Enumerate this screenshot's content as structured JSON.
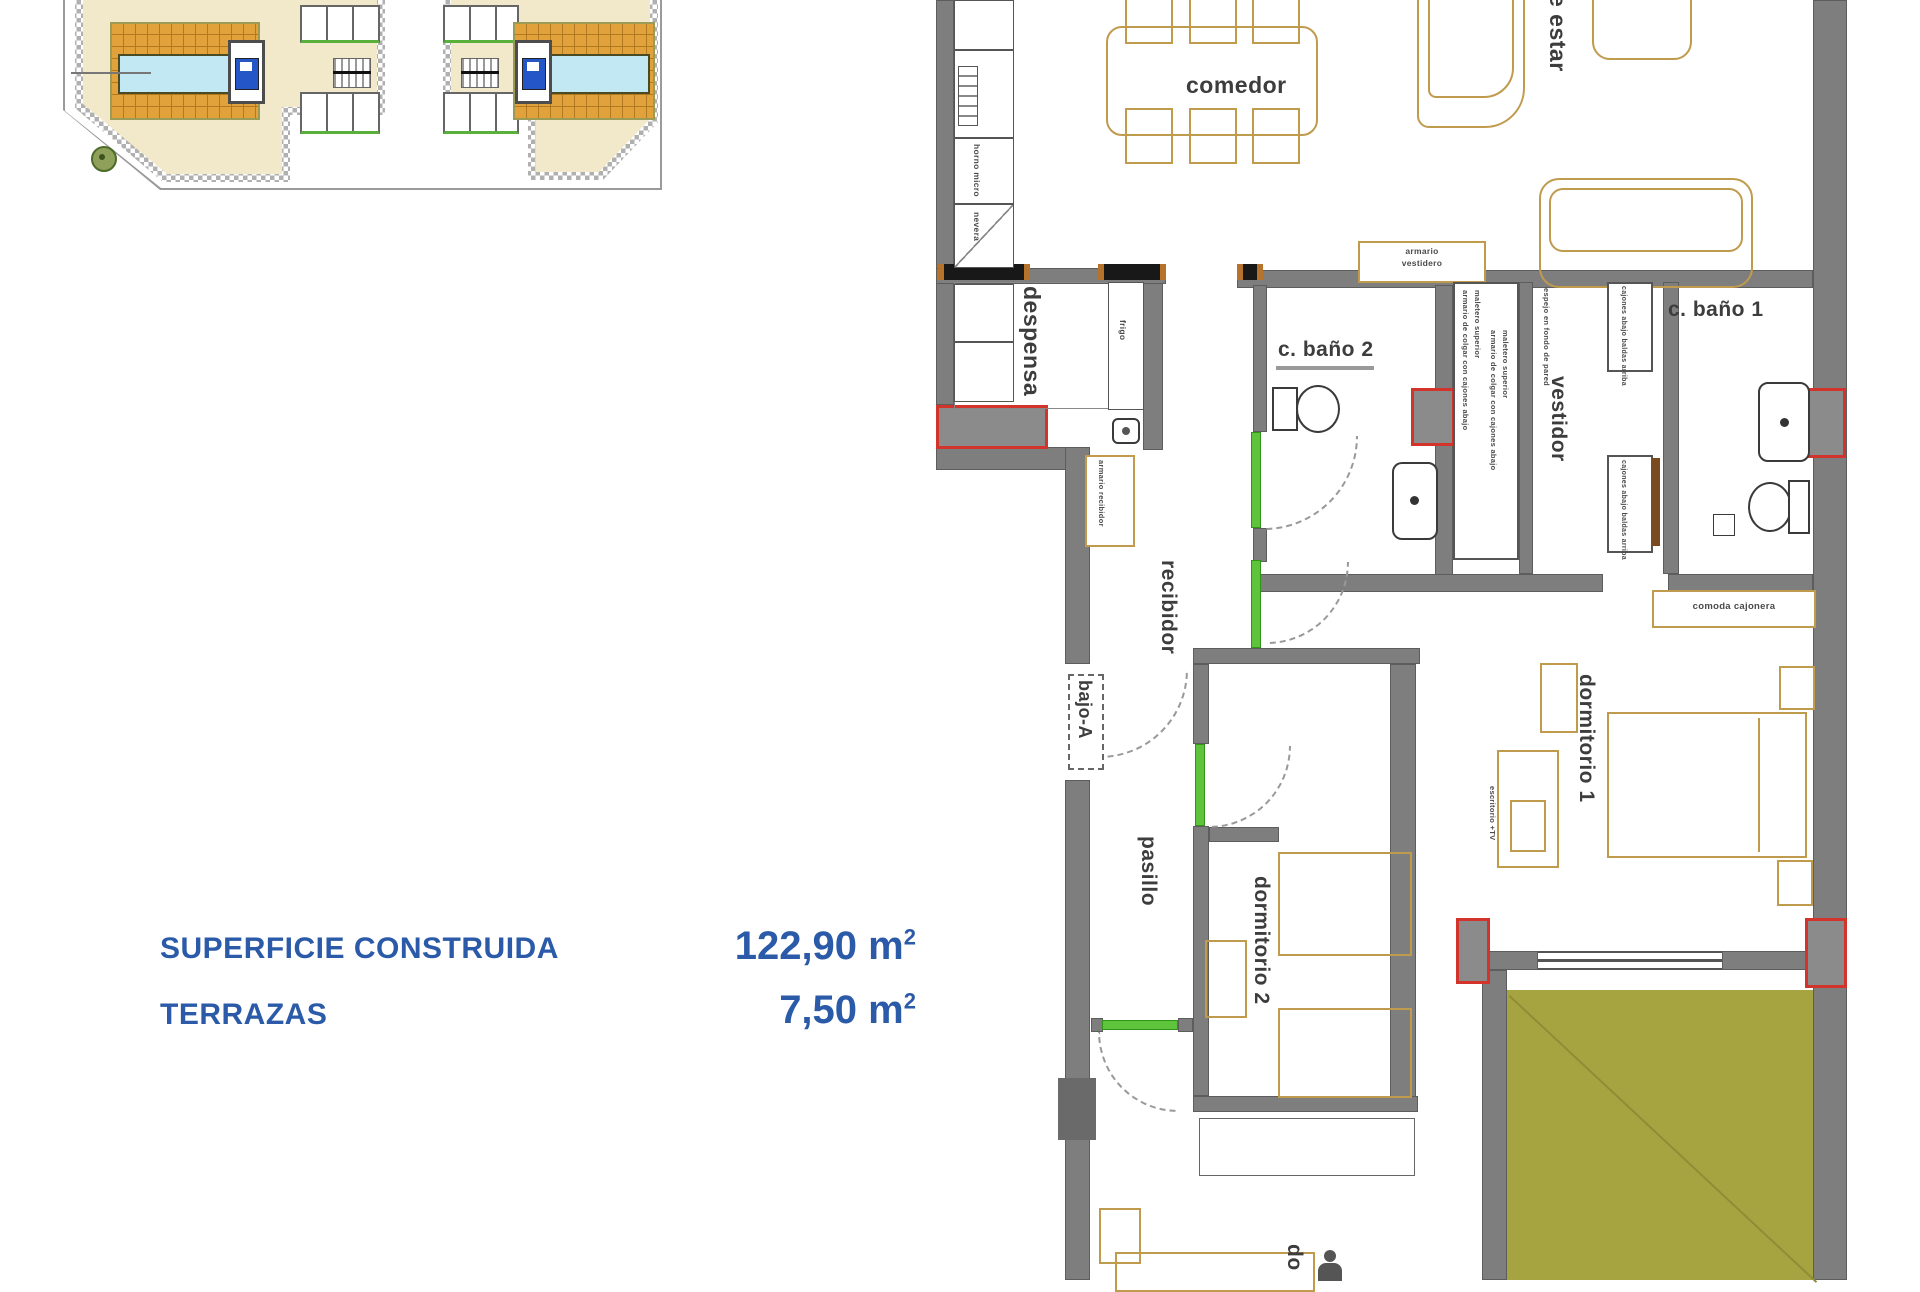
{
  "canvas": {
    "width": 1920,
    "height": 1280,
    "background": "#ffffff"
  },
  "colors": {
    "wall_gray": "#7e7e7e",
    "furniture_outline": "#c09b4e",
    "door_green": "#5ec43b",
    "shaft_red": "#d2342b",
    "terrace_olive": "#a5a441",
    "pool_blue": "#c2e9f3",
    "deck_orange": "#e2a23b",
    "site_ground_beige": "#f2e8ca",
    "label_gray": "#3d3d3d",
    "measurement_blue": "#2a5aa8"
  },
  "floor_plan": {
    "entry_label": "bajo-A",
    "room_labels": {
      "comedor": "comedor",
      "estar": "e estar",
      "despensa": "despensa",
      "frigo": "frigo",
      "bano2": "c. baño 2",
      "bano1": "c. baño 1",
      "vestidor": "vestidor",
      "recibidor": "recibidor",
      "pasillo": "pasillo",
      "dormitorio1": "dormitorio 1",
      "dormitorio2": "dormitorio 2",
      "dormitorio3_partial": "do"
    },
    "annotations": {
      "armario_vestidero_l1": "armario",
      "armario_vestidero_l2": "vestidero",
      "comoda_cajonera": "comoda cajonera",
      "armario_recibidor": "armario recibidor",
      "armario_colgar": "armario de colgar con cajones abajo",
      "maletero": "maletero superior",
      "espejo": "espejo en fondo de pared",
      "cajones_baldas": "cajones abajo baldas arriba",
      "escritorio": "escritorio +TV",
      "kitchen_1": "horno micro",
      "kitchen_2": "nevera"
    }
  },
  "measurements": {
    "rows": [
      {
        "label": "SUPERFICIE CONSTRUIDA",
        "value": "122,90",
        "unit": "m",
        "sup": "2"
      },
      {
        "label": "TERRAZAS",
        "value": "7,50",
        "unit": "m",
        "sup": "2"
      }
    ]
  }
}
